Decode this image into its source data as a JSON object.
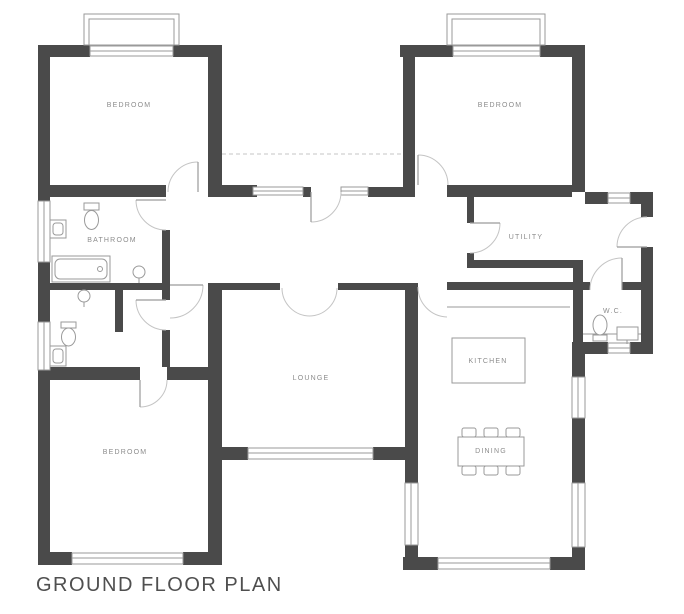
{
  "title": "GROUND FLOOR PLAN",
  "plan": {
    "rooms": [
      {
        "id": "bedroom-top-left",
        "label": "BEDROOM"
      },
      {
        "id": "bedroom-top-right",
        "label": "BEDROOM"
      },
      {
        "id": "bedroom-bottom-left",
        "label": "BEDROOM"
      },
      {
        "id": "bathroom",
        "label": "BATHROOM"
      },
      {
        "id": "lounge",
        "label": "LOUNGE"
      },
      {
        "id": "utility",
        "label": "UTILITY"
      },
      {
        "id": "kitchen",
        "label": "KITCHEN"
      },
      {
        "id": "dining",
        "label": "DINING"
      },
      {
        "id": "wc",
        "label": "W.C."
      }
    ],
    "fixtures": {
      "bathroom": [
        "toilet",
        "wash-basin",
        "pedestal-basin",
        "bathtub"
      ],
      "ensuite": [
        "toilet",
        "wash-basin",
        "pedestal-basin"
      ],
      "wc": [
        "toilet",
        "wash-basin"
      ],
      "kitchen": [
        "island-counter"
      ],
      "dining": [
        "table",
        "six-chairs"
      ]
    }
  },
  "colors": {
    "wall": "#4a4a4a",
    "line": "#9a9a9a",
    "arc": "#c4c4c4",
    "label": "#8c8c8c",
    "title": "#4f4f4f",
    "background": "#ffffff"
  }
}
